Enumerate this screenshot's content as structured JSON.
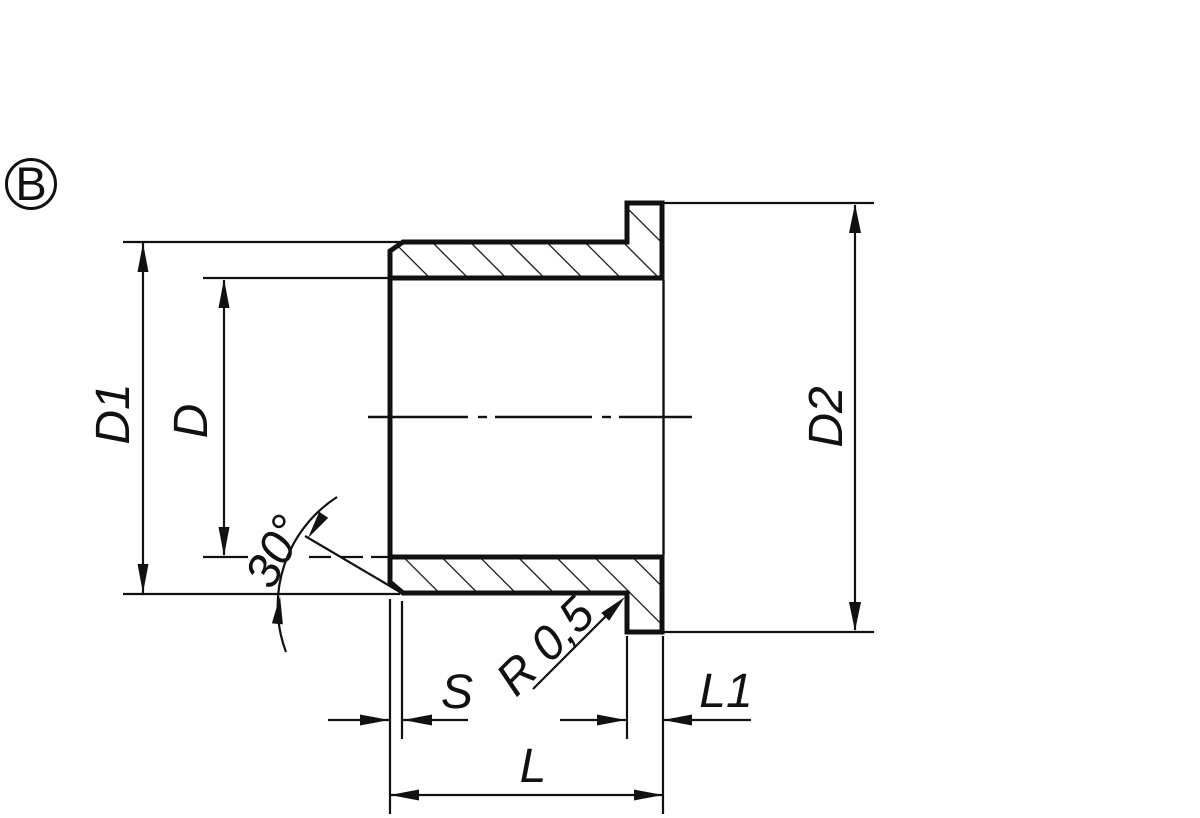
{
  "drawing": {
    "view_label": "B",
    "colors": {
      "ink": "#111111",
      "background": "#ffffff"
    },
    "labels": {
      "d1": "D1",
      "d": "D",
      "d2": "D2",
      "s": "S",
      "l1": "L1",
      "l": "L",
      "angle": "30°",
      "radius": "R 0,5"
    }
  }
}
